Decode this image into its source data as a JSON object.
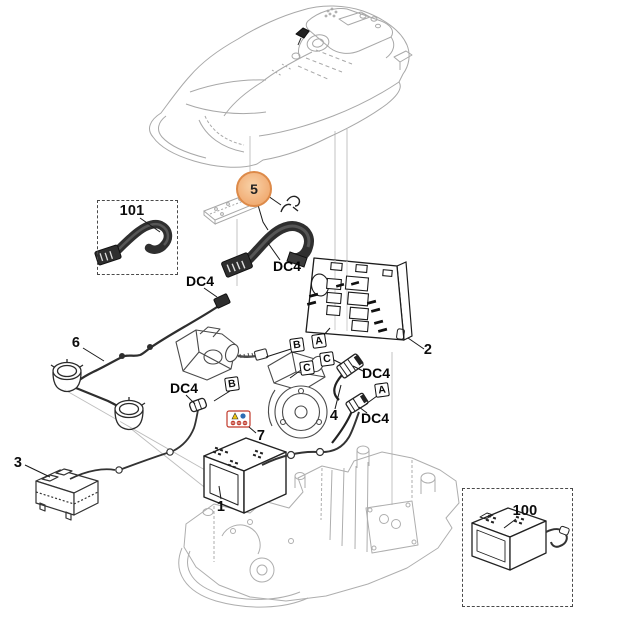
{
  "diagram_title": "robotic-mower-exploded-parts-diagram",
  "colors": {
    "background": "#ffffff",
    "light_linework": "#a8a8a8",
    "dark_linework": "#1f1f1f",
    "highlight_fill": "#f2b27c",
    "highlight_ring": "#dd8a49",
    "dashed_box_border": "#4a4a4a",
    "sticker_red": "#c0392b",
    "sticker_yellow": "#f1c40f",
    "sticker_blue": "#2e6db4"
  },
  "highlight": {
    "number": "5"
  },
  "callouts": [
    {
      "id": "part-101",
      "text": "101"
    },
    {
      "id": "part-2",
      "text": "2"
    },
    {
      "id": "part-6",
      "text": "6"
    },
    {
      "id": "part-3",
      "text": "3"
    },
    {
      "id": "part-4",
      "text": "4"
    },
    {
      "id": "part-7",
      "text": "7"
    },
    {
      "id": "part-1",
      "text": "1"
    },
    {
      "id": "part-100",
      "text": "100"
    }
  ],
  "connector_labels": [
    {
      "text": "DC4"
    },
    {
      "text": "DC4"
    },
    {
      "text": "DC4"
    },
    {
      "text": "DC4"
    },
    {
      "text": "DC4"
    }
  ],
  "port_badges": [
    {
      "letter": "B"
    },
    {
      "letter": "A"
    },
    {
      "letter": "C"
    },
    {
      "letter": "C"
    },
    {
      "letter": "B"
    },
    {
      "letter": "A"
    }
  ],
  "icons": {
    "warning_sticker": "battery-hazard-sticker"
  }
}
